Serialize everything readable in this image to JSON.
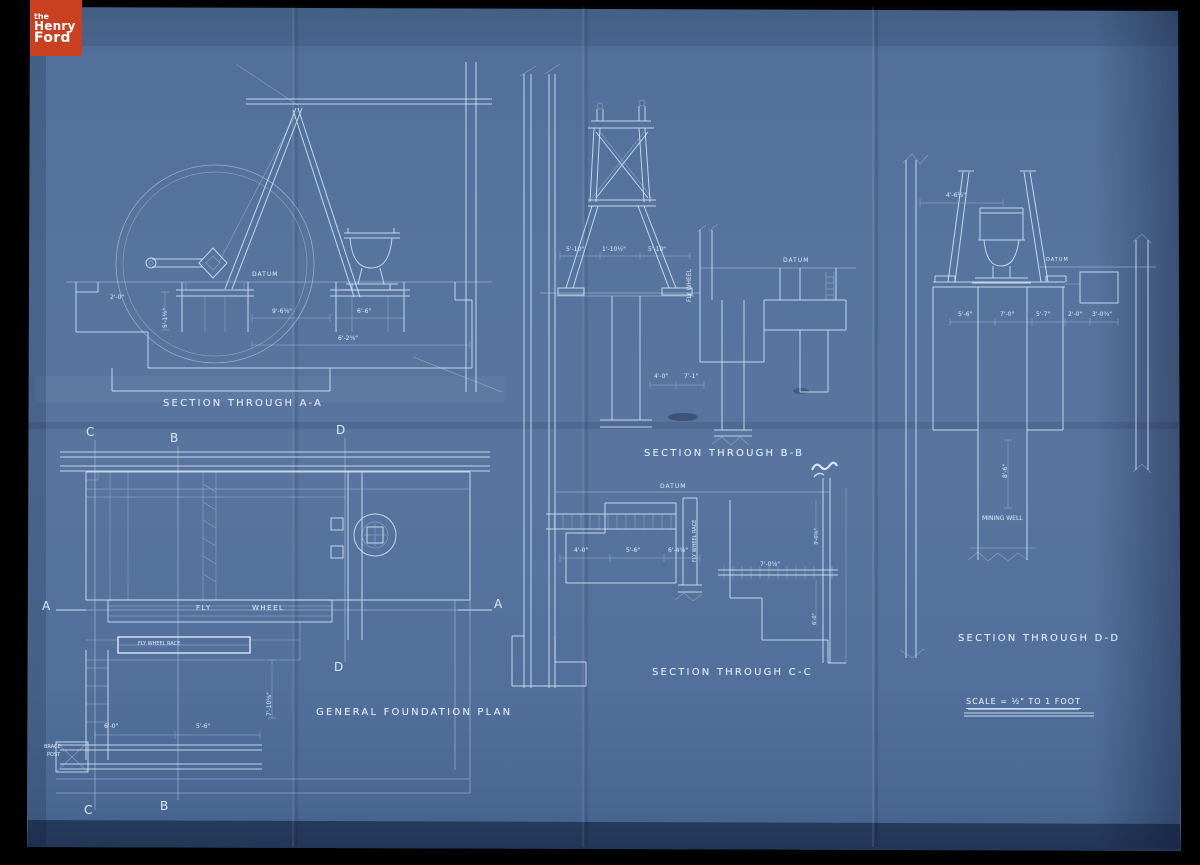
{
  "logo": {
    "line1": "the",
    "line2": "Henry",
    "line3": "Ford",
    "bg": "#c8401f",
    "fg": "#ffffff"
  },
  "sheet": {
    "base_color": "#56739f",
    "line_color": "#dde8f4",
    "background": "#000000"
  },
  "titles": {
    "section_aa": "SECTION THROUGH A-A",
    "section_bb": "SECTION THROUGH B-B",
    "section_cc": "SECTION THROUGH C-C",
    "section_dd": "SECTION THROUGH D-D",
    "foundation_plan": "GENERAL FOUNDATION PLAN",
    "scale_note": "SCALE = ½\" TO 1 FOOT"
  },
  "annotations": [
    {
      "name": "section-marker-c-top",
      "text": "C",
      "x": 86,
      "y": 425,
      "fs": 12
    },
    {
      "name": "section-marker-b-top",
      "text": "B",
      "x": 170,
      "y": 431,
      "fs": 12
    },
    {
      "name": "section-marker-d-top",
      "text": "D",
      "x": 336,
      "y": 423,
      "fs": 12
    },
    {
      "name": "section-marker-a-left",
      "text": "A",
      "x": 42,
      "y": 599,
      "fs": 12
    },
    {
      "name": "section-marker-a-right",
      "text": "A",
      "x": 494,
      "y": 597,
      "fs": 12
    },
    {
      "name": "section-marker-d-bottom",
      "text": "D",
      "x": 334,
      "y": 660,
      "fs": 12
    },
    {
      "name": "section-marker-b-bottom",
      "text": "B",
      "x": 160,
      "y": 799,
      "fs": 12
    },
    {
      "name": "section-marker-c-bottom",
      "text": "C",
      "x": 84,
      "y": 803,
      "fs": 12
    },
    {
      "name": "datum-label",
      "text": "DATUM",
      "x": 252,
      "y": 271,
      "fs": 6,
      "ls": 1
    },
    {
      "name": "datum-label",
      "text": "DATUM",
      "x": 783,
      "y": 257,
      "fs": 6,
      "ls": 1
    },
    {
      "name": "datum-label",
      "text": "DATUM",
      "x": 660,
      "y": 483,
      "fs": 6,
      "ls": 1
    },
    {
      "name": "datum-label",
      "text": "DATUM",
      "x": 1046,
      "y": 257,
      "fs": 5,
      "ls": 1
    },
    {
      "name": "fly-wheel-label",
      "text": "FLY",
      "x": 196,
      "y": 604,
      "fs": 7,
      "ls": 1.5
    },
    {
      "name": "fly-wheel-label",
      "text": "WHEEL",
      "x": 252,
      "y": 604,
      "fs": 7,
      "ls": 1.5
    },
    {
      "name": "fly-wheel-race-label",
      "text": "FLY WHEEL RACE",
      "x": 138,
      "y": 641,
      "fs": 5
    },
    {
      "name": "fly-wheel-vertical-label",
      "text": "FLY WHEEL",
      "x": 686,
      "y": 302,
      "fs": 6,
      "rot": -90
    },
    {
      "name": "fly-wheel-race-vertical-label",
      "text": "FLY WHEEL RACE",
      "x": 692,
      "y": 562,
      "fs": 5,
      "rot": -90
    },
    {
      "name": "mining-well-label",
      "text": "MINING WELL",
      "x": 982,
      "y": 515,
      "fs": 6
    },
    {
      "name": "brace-post-label",
      "text": "BRACE",
      "x": 44,
      "y": 744,
      "fs": 5
    },
    {
      "name": "brace-post-label",
      "text": "POST",
      "x": 47,
      "y": 752,
      "fs": 5
    },
    {
      "name": "dimension-label",
      "text": "9'-6⅝\"",
      "x": 272,
      "y": 308,
      "fs": 6
    },
    {
      "name": "dimension-label",
      "text": "6'-6\"",
      "x": 357,
      "y": 308,
      "fs": 6
    },
    {
      "name": "dimension-label",
      "text": "6'-2⅝\"",
      "x": 338,
      "y": 335,
      "fs": 6
    },
    {
      "name": "dimension-label",
      "text": "2'-0\"",
      "x": 110,
      "y": 294,
      "fs": 6
    },
    {
      "name": "dimension-label",
      "text": "5'-1½\"",
      "x": 162,
      "y": 328,
      "fs": 6,
      "rot": -90
    },
    {
      "name": "dimension-label",
      "text": "5'-10\"",
      "x": 566,
      "y": 246,
      "fs": 6
    },
    {
      "name": "dimension-label",
      "text": "1'-10½\"",
      "x": 602,
      "y": 246,
      "fs": 6
    },
    {
      "name": "dimension-label",
      "text": "5'-10\"",
      "x": 648,
      "y": 246,
      "fs": 6
    },
    {
      "name": "dimension-label",
      "text": "4'-0\"",
      "x": 654,
      "y": 373,
      "fs": 6
    },
    {
      "name": "dimension-label",
      "text": "7'-1\"",
      "x": 684,
      "y": 373,
      "fs": 6
    },
    {
      "name": "dimension-label",
      "text": "4'-0\"",
      "x": 574,
      "y": 547,
      "fs": 6
    },
    {
      "name": "dimension-label",
      "text": "5'-6\"",
      "x": 626,
      "y": 547,
      "fs": 6
    },
    {
      "name": "dimension-label",
      "text": "6'-4⅝\"",
      "x": 668,
      "y": 547,
      "fs": 6
    },
    {
      "name": "dimension-label",
      "text": "7'-0⅝\"",
      "x": 760,
      "y": 561,
      "fs": 6
    },
    {
      "name": "dimension-label",
      "text": "3'-0⅝\"",
      "x": 814,
      "y": 545,
      "fs": 5,
      "rot": -90
    },
    {
      "name": "dimension-label",
      "text": "6'-0\"",
      "x": 812,
      "y": 625,
      "fs": 5,
      "rot": -90
    },
    {
      "name": "dimension-label",
      "text": "4'-6½\"",
      "x": 946,
      "y": 192,
      "fs": 6
    },
    {
      "name": "dimension-label",
      "text": "5'-6\"",
      "x": 958,
      "y": 311,
      "fs": 6
    },
    {
      "name": "dimension-label",
      "text": "7'-0\"",
      "x": 1000,
      "y": 311,
      "fs": 6
    },
    {
      "name": "dimension-label",
      "text": "5'-7\"",
      "x": 1036,
      "y": 311,
      "fs": 6
    },
    {
      "name": "dimension-label",
      "text": "2'-0\"",
      "x": 1068,
      "y": 311,
      "fs": 6
    },
    {
      "name": "dimension-label",
      "text": "3'-0¾\"",
      "x": 1092,
      "y": 311,
      "fs": 6
    },
    {
      "name": "dimension-label",
      "text": "8'-6\"",
      "x": 1002,
      "y": 478,
      "fs": 6,
      "rot": -90
    },
    {
      "name": "dimension-label",
      "text": "6'-0\"",
      "x": 104,
      "y": 723,
      "fs": 6
    },
    {
      "name": "dimension-label",
      "text": "5'-6\"",
      "x": 196,
      "y": 723,
      "fs": 6
    },
    {
      "name": "dimension-label",
      "text": "7'-10⅝\"",
      "x": 266,
      "y": 716,
      "fs": 6,
      "rot": -90
    }
  ]
}
